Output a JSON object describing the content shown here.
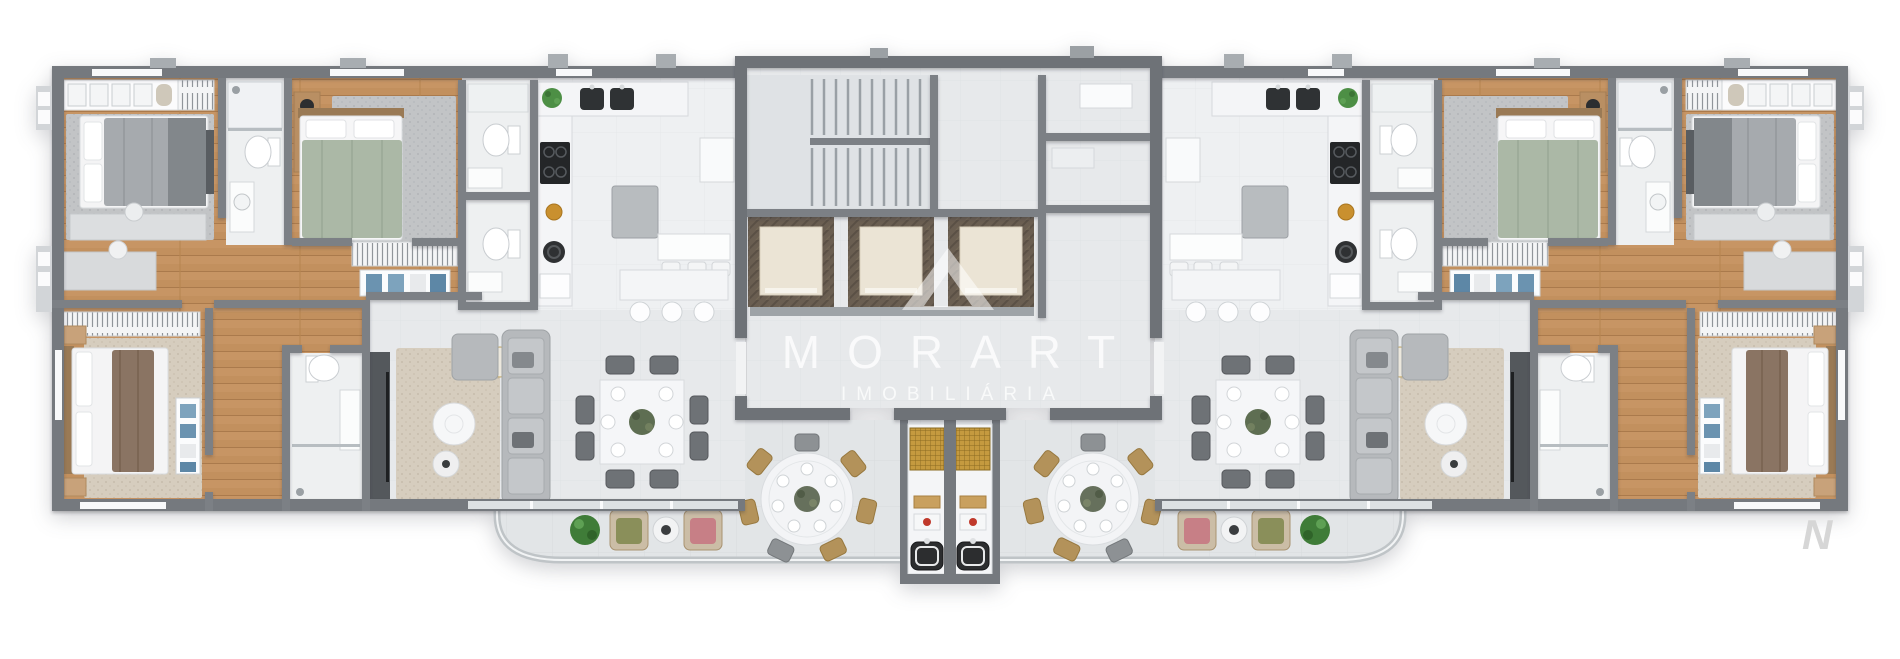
{
  "scene": {
    "description": "Top-down 3D render of a residential building floor plan with two mirrored apartments, central stair and elevator core, and curved front terrace",
    "background": "#ffffff"
  },
  "watermark": {
    "logo_icon": "triangle-monogram",
    "title": "MORART",
    "subtitle": "IMOBILIÁRIA",
    "color": "#ffffff"
  },
  "corner_logo": {
    "glyph": "N",
    "color": "#d6d6d6"
  },
  "palette": {
    "wall": "#75797e",
    "wall_partition": "#7c8085",
    "floor_tile": "#e7e9eb",
    "kitchen_floor": "#eef0f2",
    "terrace_floor": "#e2e5e7",
    "wood_floor": "#c2905e",
    "marble_counter": "#f4f5f7",
    "rug_beige": "#d6cdbe",
    "rug_gray": "#c2c4c6",
    "bed_gray": "#a6aaae",
    "bed_sage": "#abb8a6",
    "elevator_frame": "#6a5e51",
    "elevator_cab": "#ebe4d5",
    "grill_gold": "#c59a3f",
    "plant_green": "#4d8f45",
    "drawer_blue": "#6b93b0",
    "sink_black": "#2c2d2f"
  },
  "plan_features": {
    "apartments": 2,
    "mirrored_layout": true,
    "elevators": 3,
    "staircase_flights": 2,
    "bedrooms_per_apartment": 3,
    "bathrooms_per_apartment": 4,
    "square_dining_tables": 2,
    "chairs_per_square_table": 8,
    "terrace_round_tables": 2,
    "kitchen_island_stools": 3,
    "barbecue_stations": 2
  }
}
